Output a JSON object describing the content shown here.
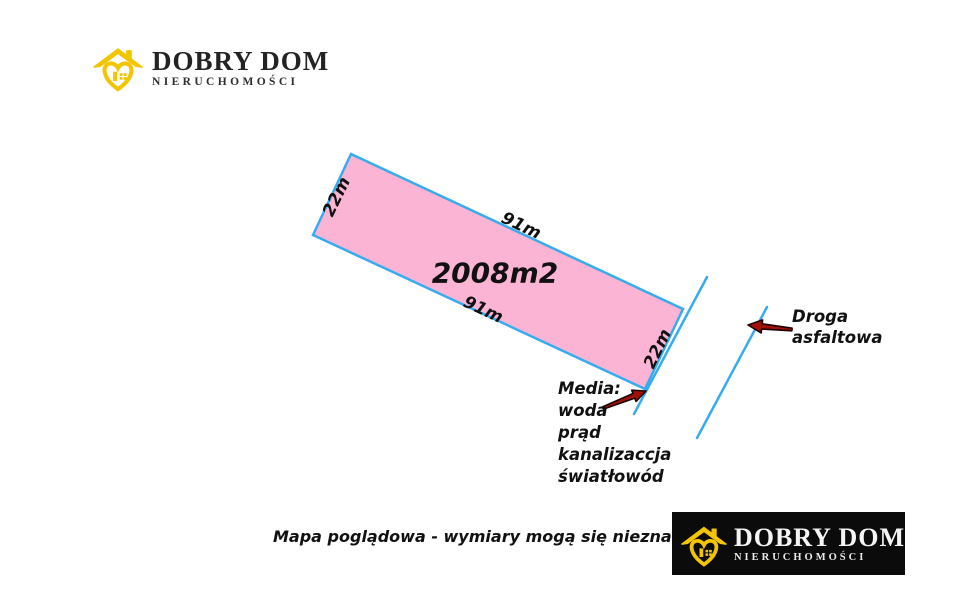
{
  "branding": {
    "name": "DOBRY DOM",
    "subtitle": "NIERUCHOMOŚCI",
    "logo_icon": "house-heart-icon",
    "colors": {
      "yellow": "#F2C500",
      "header_text": "#232323",
      "footer_bg": "#0B0B0B",
      "footer_text": "#F4F4F4"
    }
  },
  "diagram": {
    "plot": {
      "area_label": "2008m2",
      "side_labels": {
        "top": "91m",
        "bottom": "91m",
        "left": "22m",
        "right": "22m"
      },
      "fill_color": "#FBB4D3",
      "border_color": "#36ACEE",
      "rotation_deg": 25
    },
    "road": {
      "label_line1": "Droga",
      "label_line2": "asfaltowa",
      "line_color": "#36ACEE",
      "arrow_color": "#A01208",
      "arrow_outline": "#1C0000"
    },
    "media": {
      "title": "Media:",
      "items": [
        "woda",
        "prąd",
        "kanalizaccja",
        "światłowód"
      ]
    }
  },
  "footer": {
    "disclaimer": "Mapa poglądowa - wymiary mogą się nieznacznie różnić"
  }
}
